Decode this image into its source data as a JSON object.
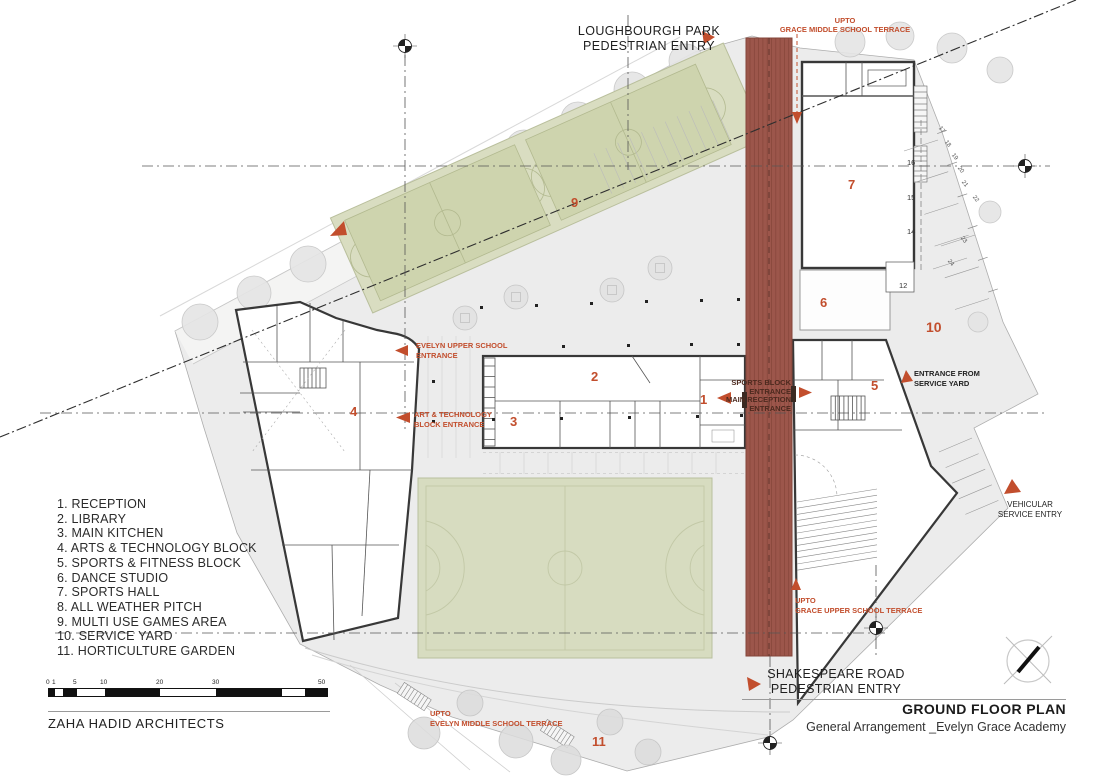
{
  "colors": {
    "accent_orange": "#c24e2d",
    "track_red": "#9c564b",
    "track_stripe": "#85453a",
    "pitch_green": "#d7dcc0",
    "muga_green": "#d9ddc1",
    "court_green": "#ced4ae",
    "site_gray": "#ececec",
    "wall_dark": "#383838"
  },
  "legend": {
    "items": [
      "1. RECEPTION",
      "2. LIBRARY",
      "3. MAIN KITCHEN",
      "4. ARTS & TECHNOLOGY BLOCK",
      "5. SPORTS & FITNESS BLOCK",
      "6. DANCE STUDIO",
      "7. SPORTS HALL",
      "8. ALL WEATHER PITCH",
      "9. MULTI USE GAMES AREA",
      "10. SERVICE YARD",
      "11. HORTICULTURE GARDEN"
    ]
  },
  "labels": {
    "loughbourgh": {
      "line1": "LOUGHBOURGH PARK",
      "line2": "PEDESTRIAN ENTRY"
    },
    "upto_grace_middle": {
      "line1": "UPTO",
      "line2": "GRACE MIDDLE SCHOOL TERRACE"
    },
    "evelyn_upper": {
      "line1": "EVELYN UPPER SCHOOL",
      "line2": "ENTRANCE"
    },
    "art_tech": {
      "line1": "ART & TECHNOLOGY",
      "line2": "BLOCK ENTRANCE"
    },
    "sports_block": {
      "line1": "SPORTS BLOCK",
      "line2": "ENTRANCE"
    },
    "main_reception": {
      "line1": "MAIN RECEPTION",
      "line2": "ENTRANCE"
    },
    "entrance_service_yard": {
      "line1": "ENTRANCE FROM",
      "line2": "SERVICE YARD"
    },
    "vehicular": {
      "line1": "VEHICULAR",
      "line2": "SERVICE ENTRY"
    },
    "upto_grace_upper": {
      "line1": "UPTO",
      "line2": "GRACE UPPER SCHOOL TERRACE"
    },
    "shakespeare": {
      "line1": "SHAKESPEARE ROAD",
      "line2": "PEDESTRIAN ENTRY"
    },
    "upto_evelyn_middle": {
      "line1": "UPTO",
      "line2": "EVELYN MIDDLE SCHOOL TERRACE"
    }
  },
  "plan_numbers": {
    "reception": "1",
    "library": "2",
    "main_kitchen": "3",
    "arts_tech": "4",
    "sports_fitness": "5",
    "dance_studio": "6",
    "sports_hall": "7",
    "muga": "9",
    "service_yard": "10",
    "horticulture": "11"
  },
  "grid_numbers": {
    "g12": "12",
    "g14": "14",
    "g15": "15",
    "g16": "16",
    "p17": "17",
    "p18": "18",
    "p19": "19",
    "p20": "20",
    "p21": "21",
    "p22": "22",
    "p23": "23",
    "p24": "24"
  },
  "scale_bar": {
    "ticks": [
      "0",
      "1",
      "5",
      "10",
      "20",
      "30",
      "50"
    ]
  },
  "title_block": {
    "title": "GROUND FLOOR PLAN",
    "subtitle": "General Arrangement _Evelyn Grace Academy",
    "firm": "ZAHA HADID ARCHITECTS"
  }
}
